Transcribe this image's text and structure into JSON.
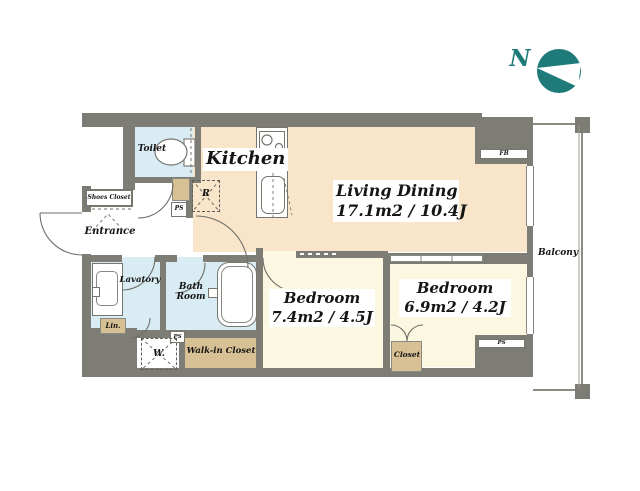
{
  "compass": {
    "label": "N"
  },
  "rooms": {
    "toilet": {
      "label": "Toilet"
    },
    "kitchen": {
      "label": "Kitchen"
    },
    "living_dining": {
      "name": "Living Dining",
      "size": "17.1m2 / 10.4J"
    },
    "bedroom_main": {
      "name": "Bedroom",
      "size": "7.4m2 / 4.5J"
    },
    "bedroom_second": {
      "name": "Bedroom",
      "size": "6.9m2 / 4.2J"
    },
    "entrance": {
      "label": "Entrance"
    },
    "shoes_closet": {
      "label": "Shoes Closet"
    },
    "lavatory": {
      "label": "Lavatory"
    },
    "bath_room": {
      "label_line1": "Bath",
      "label_line2": "Room"
    },
    "linen": {
      "label": "Lin."
    },
    "washing_machine": {
      "label": "W."
    },
    "walk_in_closet": {
      "label": "Walk-in Closet"
    },
    "closet": {
      "label": "Closet"
    },
    "balcony": {
      "label": "Balcony"
    }
  },
  "utility": {
    "ps": "PS",
    "fb": "FB",
    "refrigerator": "R"
  },
  "colors": {
    "wall": "#7e7d75",
    "living_floor": "#f9e5c9",
    "bedroom_floor": "#fcf7e1",
    "wet_area_floor": "#d9ecf4",
    "closet_fill": "#d6c094",
    "compass_teal": "#1e7b7a"
  }
}
